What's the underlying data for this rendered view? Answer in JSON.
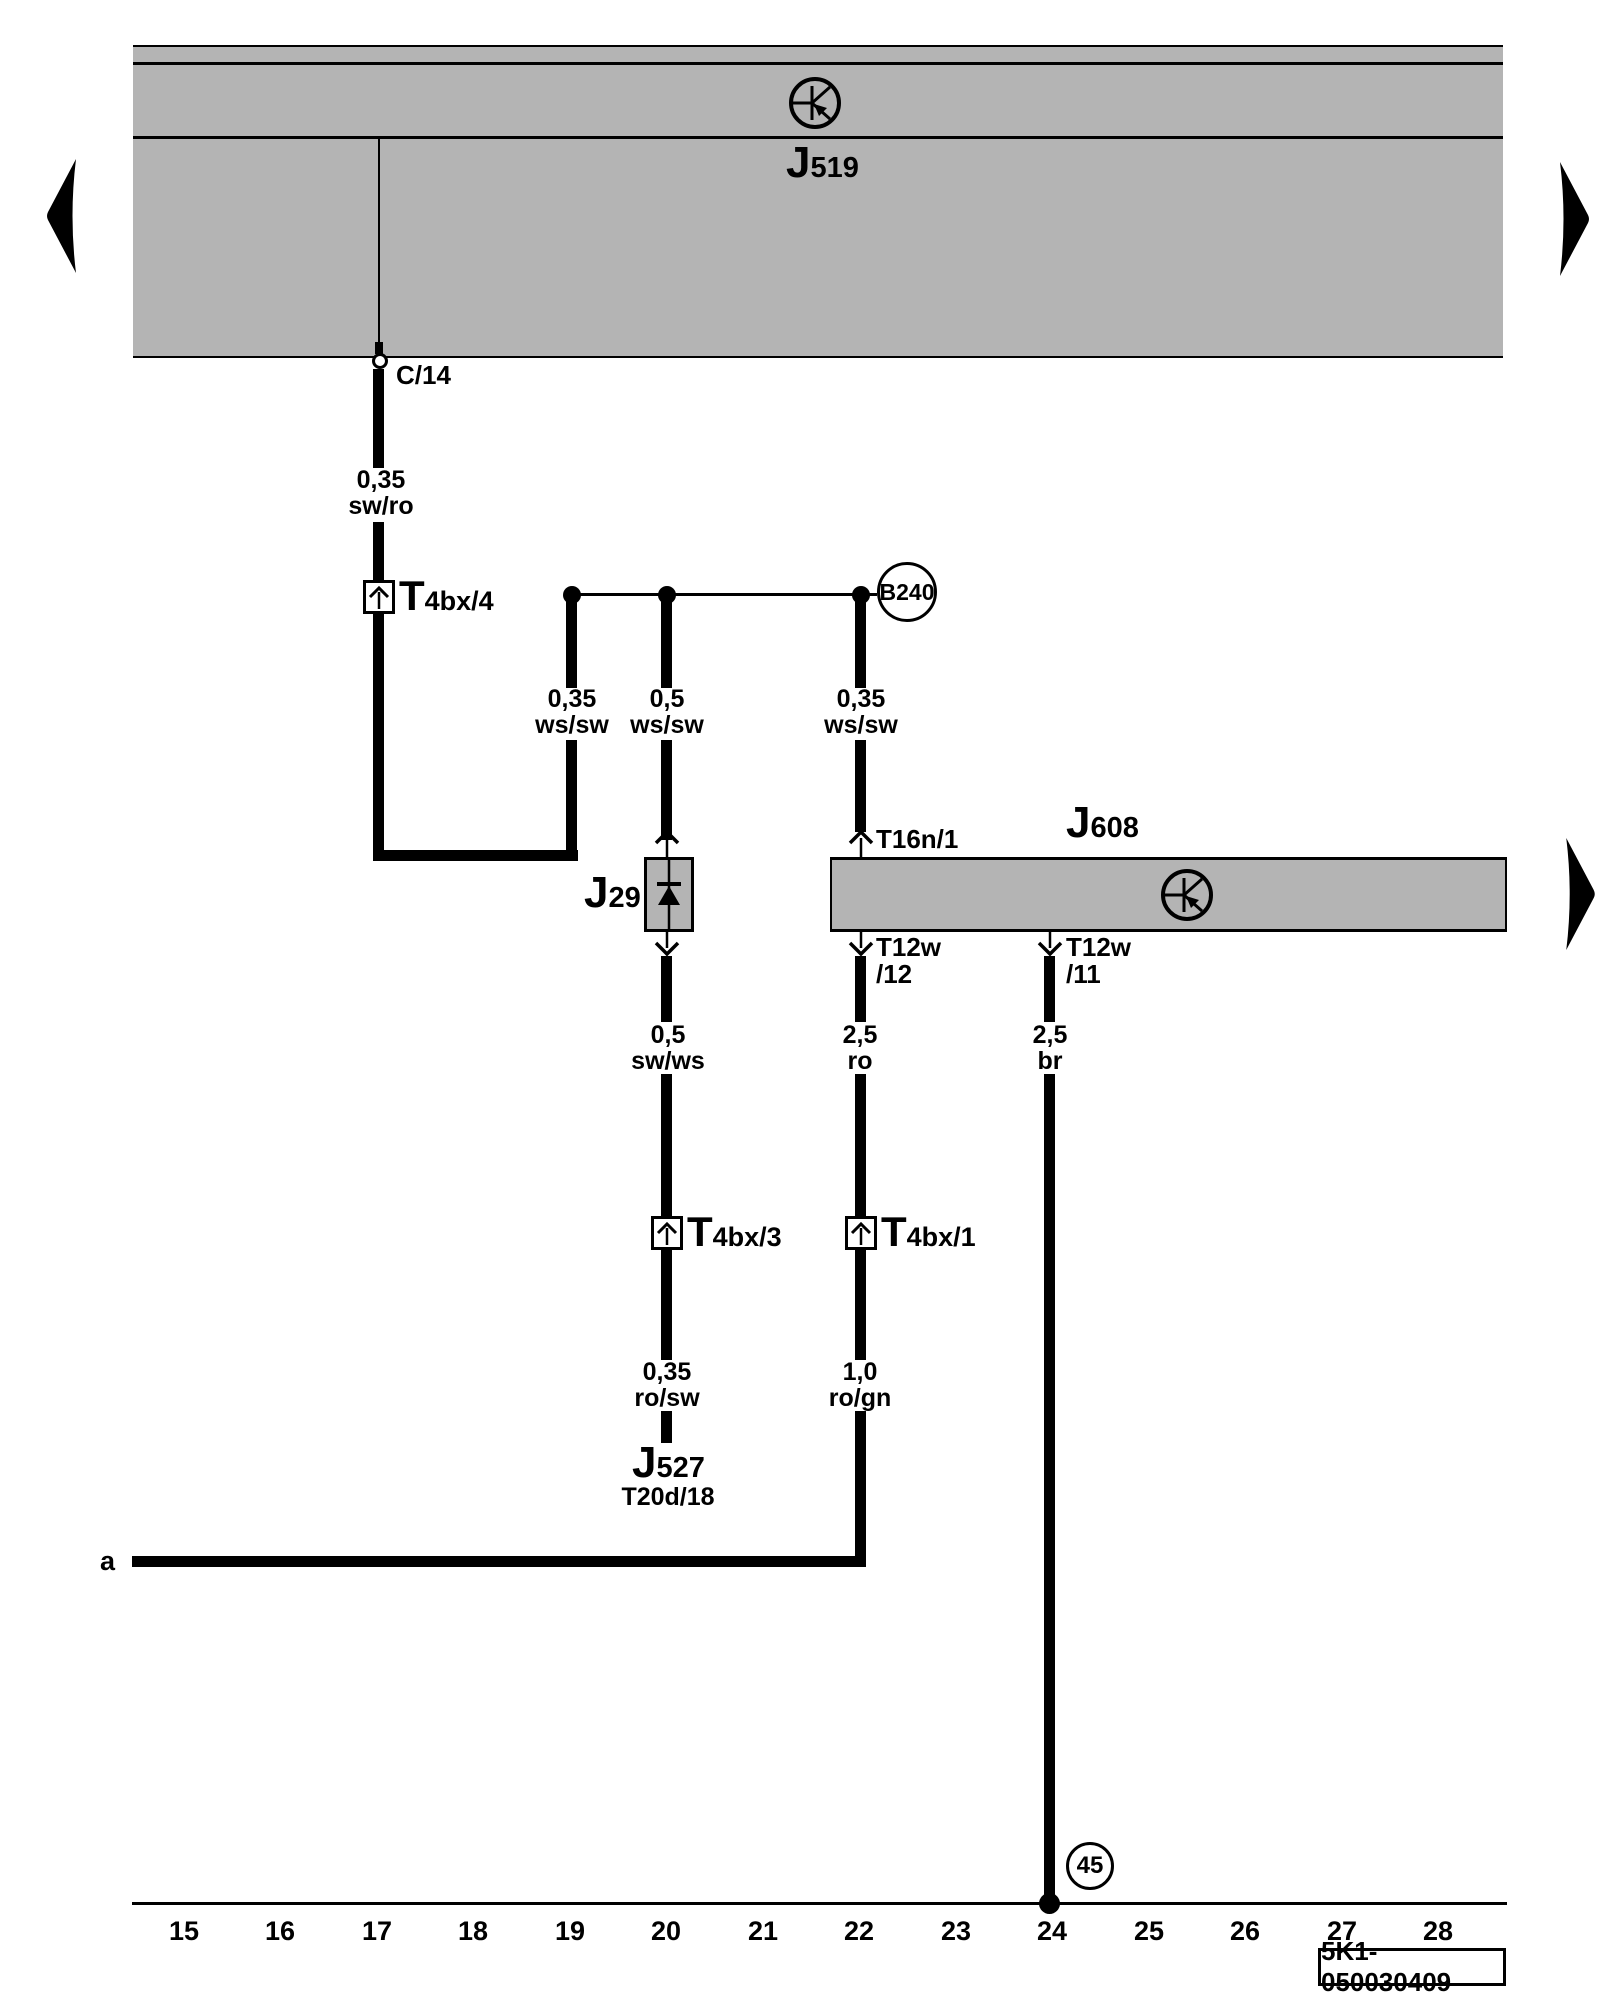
{
  "page": {
    "background": "#ffffff",
    "box_gray": "#b4b4b4",
    "line_black": "#000000",
    "code_label": "5K1-050030409"
  },
  "components": {
    "j519": {
      "main": "J",
      "sub": "519"
    },
    "j608": {
      "main": "J",
      "sub": "608"
    },
    "j29": {
      "main": "J",
      "sub": "29"
    },
    "j527": {
      "main": "J",
      "sub": "527",
      "pin": "T20d/18"
    },
    "b240": {
      "label": "B240"
    },
    "ground45": {
      "label": "45"
    }
  },
  "connectors": {
    "c14": {
      "label": "C/14"
    },
    "t4bx4": {
      "main": "T",
      "sub": "4bx/4"
    },
    "t4bx3": {
      "main": "T",
      "sub": "4bx/3"
    },
    "t4bx1": {
      "main": "T",
      "sub": "4bx/1"
    },
    "t16n1": {
      "label": "T16n/1"
    },
    "t12w12": {
      "line1": "T12w",
      "line2": "/12"
    },
    "t12w11": {
      "line1": "T12w",
      "line2": "/11"
    }
  },
  "wires": {
    "sw_ro": {
      "size": "0,35",
      "color": "sw/ro"
    },
    "ws_sw_1": {
      "size": "0,35",
      "color": "ws/sw"
    },
    "ws_sw_2": {
      "size": "0,5",
      "color": "ws/sw"
    },
    "ws_sw_3": {
      "size": "0,35",
      "color": "ws/sw"
    },
    "sw_ws": {
      "size": "0,5",
      "color": "sw/ws"
    },
    "ro": {
      "size": "2,5",
      "color": "ro"
    },
    "br": {
      "size": "2,5",
      "color": "br"
    },
    "ro_sw": {
      "size": "0,35",
      "color": "ro/sw"
    },
    "ro_gn": {
      "size": "1,0",
      "color": "ro/gn"
    },
    "a_label": "a"
  },
  "ruler": {
    "cols": [
      "15",
      "16",
      "17",
      "18",
      "19",
      "20",
      "21",
      "22",
      "23",
      "24",
      "25",
      "26",
      "27",
      "28"
    ]
  }
}
